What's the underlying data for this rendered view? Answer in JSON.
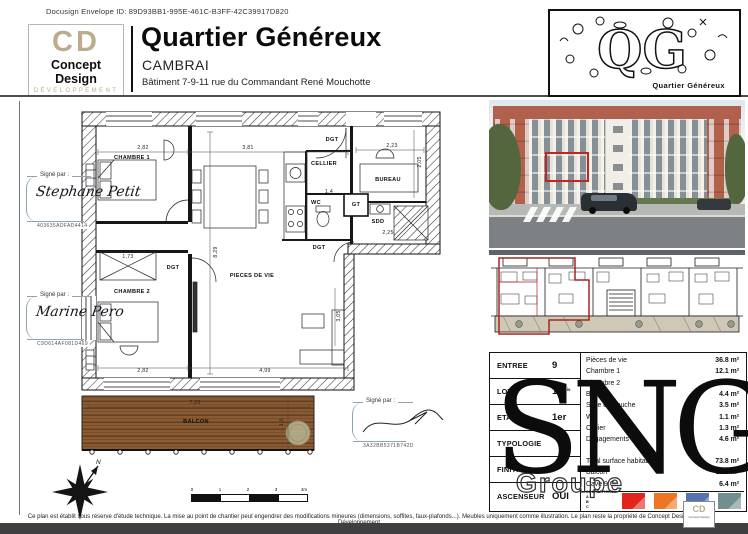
{
  "docusign": {
    "line": "Docusign Envelope ID: 89D93BB1-995E-461C-B3FF-42C39917D820"
  },
  "header": {
    "logo": {
      "initials": "CD",
      "name": "Concept Design",
      "tagline": "DÉVELOPPEMENT"
    },
    "title": "Quartier Généreux",
    "city": "CAMBRAI",
    "building": "Bâtiment 7-9-11 rue du Commandant René Mouchotte",
    "qg": {
      "letters": "QG",
      "caption": "Quartier Généreux"
    }
  },
  "signatures": [
    {
      "label": "Signé par :",
      "name": "Stephane Petit",
      "code": "403635ADFAD4414"
    },
    {
      "label": "Signé par :",
      "name": "Marine Pero",
      "code": "C9D614AF081D469"
    },
    {
      "label": "Signé par :",
      "name": "",
      "code": "3A32BB5371B742D"
    }
  ],
  "plan": {
    "labels": [
      {
        "t": "CHAMBRE 1",
        "x": 84,
        "y": 52
      },
      {
        "t": "CHAMBRE 2",
        "x": 84,
        "y": 186
      },
      {
        "t": "PIECES DE VIE",
        "x": 204,
        "y": 170
      },
      {
        "t": "CELLIER",
        "x": 276,
        "y": 58
      },
      {
        "t": "BUREAU",
        "x": 340,
        "y": 74
      },
      {
        "t": "WC",
        "x": 268,
        "y": 97
      },
      {
        "t": "SDD",
        "x": 330,
        "y": 116
      },
      {
        "t": "GT",
        "x": 308,
        "y": 99
      },
      {
        "t": "DGT",
        "x": 284,
        "y": 34
      },
      {
        "t": "DGT",
        "x": 271,
        "y": 142
      },
      {
        "t": "DGT",
        "x": 125,
        "y": 162
      },
      {
        "t": "BALCON",
        "x": 148,
        "y": 316
      },
      {
        "t": "2,82",
        "x": 95,
        "y": 42,
        "dim": 1
      },
      {
        "t": "3,81",
        "x": 200,
        "y": 42,
        "dim": 1
      },
      {
        "t": "2,23",
        "x": 344,
        "y": 40,
        "dim": 1
      },
      {
        "t": "2,05",
        "x": 372,
        "y": 56,
        "dim": 1,
        "r": 1
      },
      {
        "t": "1,4",
        "x": 281,
        "y": 86,
        "dim": 1
      },
      {
        "t": "2,25",
        "x": 340,
        "y": 127,
        "dim": 1
      },
      {
        "t": "1,73",
        "x": 80,
        "y": 151,
        "dim": 1
      },
      {
        "t": "8,29",
        "x": 168,
        "y": 146,
        "dim": 1,
        "r": 1
      },
      {
        "t": "3,05",
        "x": 291,
        "y": 210,
        "dim": 1,
        "r": 1
      },
      {
        "t": "2,82",
        "x": 95,
        "y": 265,
        "dim": 1
      },
      {
        "t": "4,99",
        "x": 217,
        "y": 265,
        "dim": 1
      },
      {
        "t": "7,20",
        "x": 147,
        "y": 297,
        "dim": 1
      },
      {
        "t": "1,6",
        "x": 234,
        "y": 316,
        "dim": 1,
        "r": 1
      }
    ]
  },
  "info_table": {
    "left_rows": [
      {
        "label": "ENTREE",
        "value": "9",
        "suffix": ""
      },
      {
        "label": "LOT",
        "value": "11",
        "suffix": "bis"
      },
      {
        "label": "ETAGE",
        "value": "1er",
        "suffix": ""
      },
      {
        "label": "TYPOLOGIE",
        "value": "",
        "suffix": ""
      },
      {
        "label": "FINITION",
        "value": "",
        "suffix": ""
      },
      {
        "label": "ASCENSEUR",
        "value": "OUI",
        "suffix": ""
      }
    ],
    "areas": [
      {
        "label": "Pièces de vie",
        "value": "36.8 m²"
      },
      {
        "label": "Chambre 1",
        "value": "12.1 m²"
      },
      {
        "label": "Chambre 2",
        "value": "10 m²"
      },
      {
        "label": "Bureau",
        "value": "4.4 m²"
      },
      {
        "label": "Salle de douche",
        "value": "3.5 m²"
      },
      {
        "label": "WC",
        "value": "1.1 m²"
      },
      {
        "label": "Cellier",
        "value": "1.3 m²"
      },
      {
        "label": "Dégagements",
        "value": "4.6 m²"
      }
    ],
    "totals": [
      {
        "label": "Total surface habitable",
        "value": "73.8 m²"
      },
      {
        "label": "Balcon",
        "value": "11.5 m²"
      },
      {
        "label": "Cave 9.C",
        "value": "6.4 m²"
      }
    ]
  },
  "swatches": {
    "label": "ADAPTATIONS",
    "letters": [
      "A",
      "B",
      "C"
    ],
    "colors": [
      "#e1251b",
      "#ee7623",
      "#5572b5",
      "#718f8f"
    ]
  },
  "watermark": {
    "main": "SNG",
    "sub": "Groupe"
  },
  "compass": {
    "north": "N"
  },
  "scalebar": {
    "ticks": [
      "0",
      "1",
      "2",
      "3",
      "4m"
    ]
  },
  "footer": {
    "disclaimer": "Ce plan est établit sous réserve d'étude technique. La mise au point de chantier peut engendrer des modifications mineures (dimensions, soffites, faux-plafonds...). Meubles uniquement comme illustration. Le plan reste la propriété de Concept Design Développement",
    "cd_mini": {
      "initials": "CD",
      "name": "Concept Design"
    }
  }
}
